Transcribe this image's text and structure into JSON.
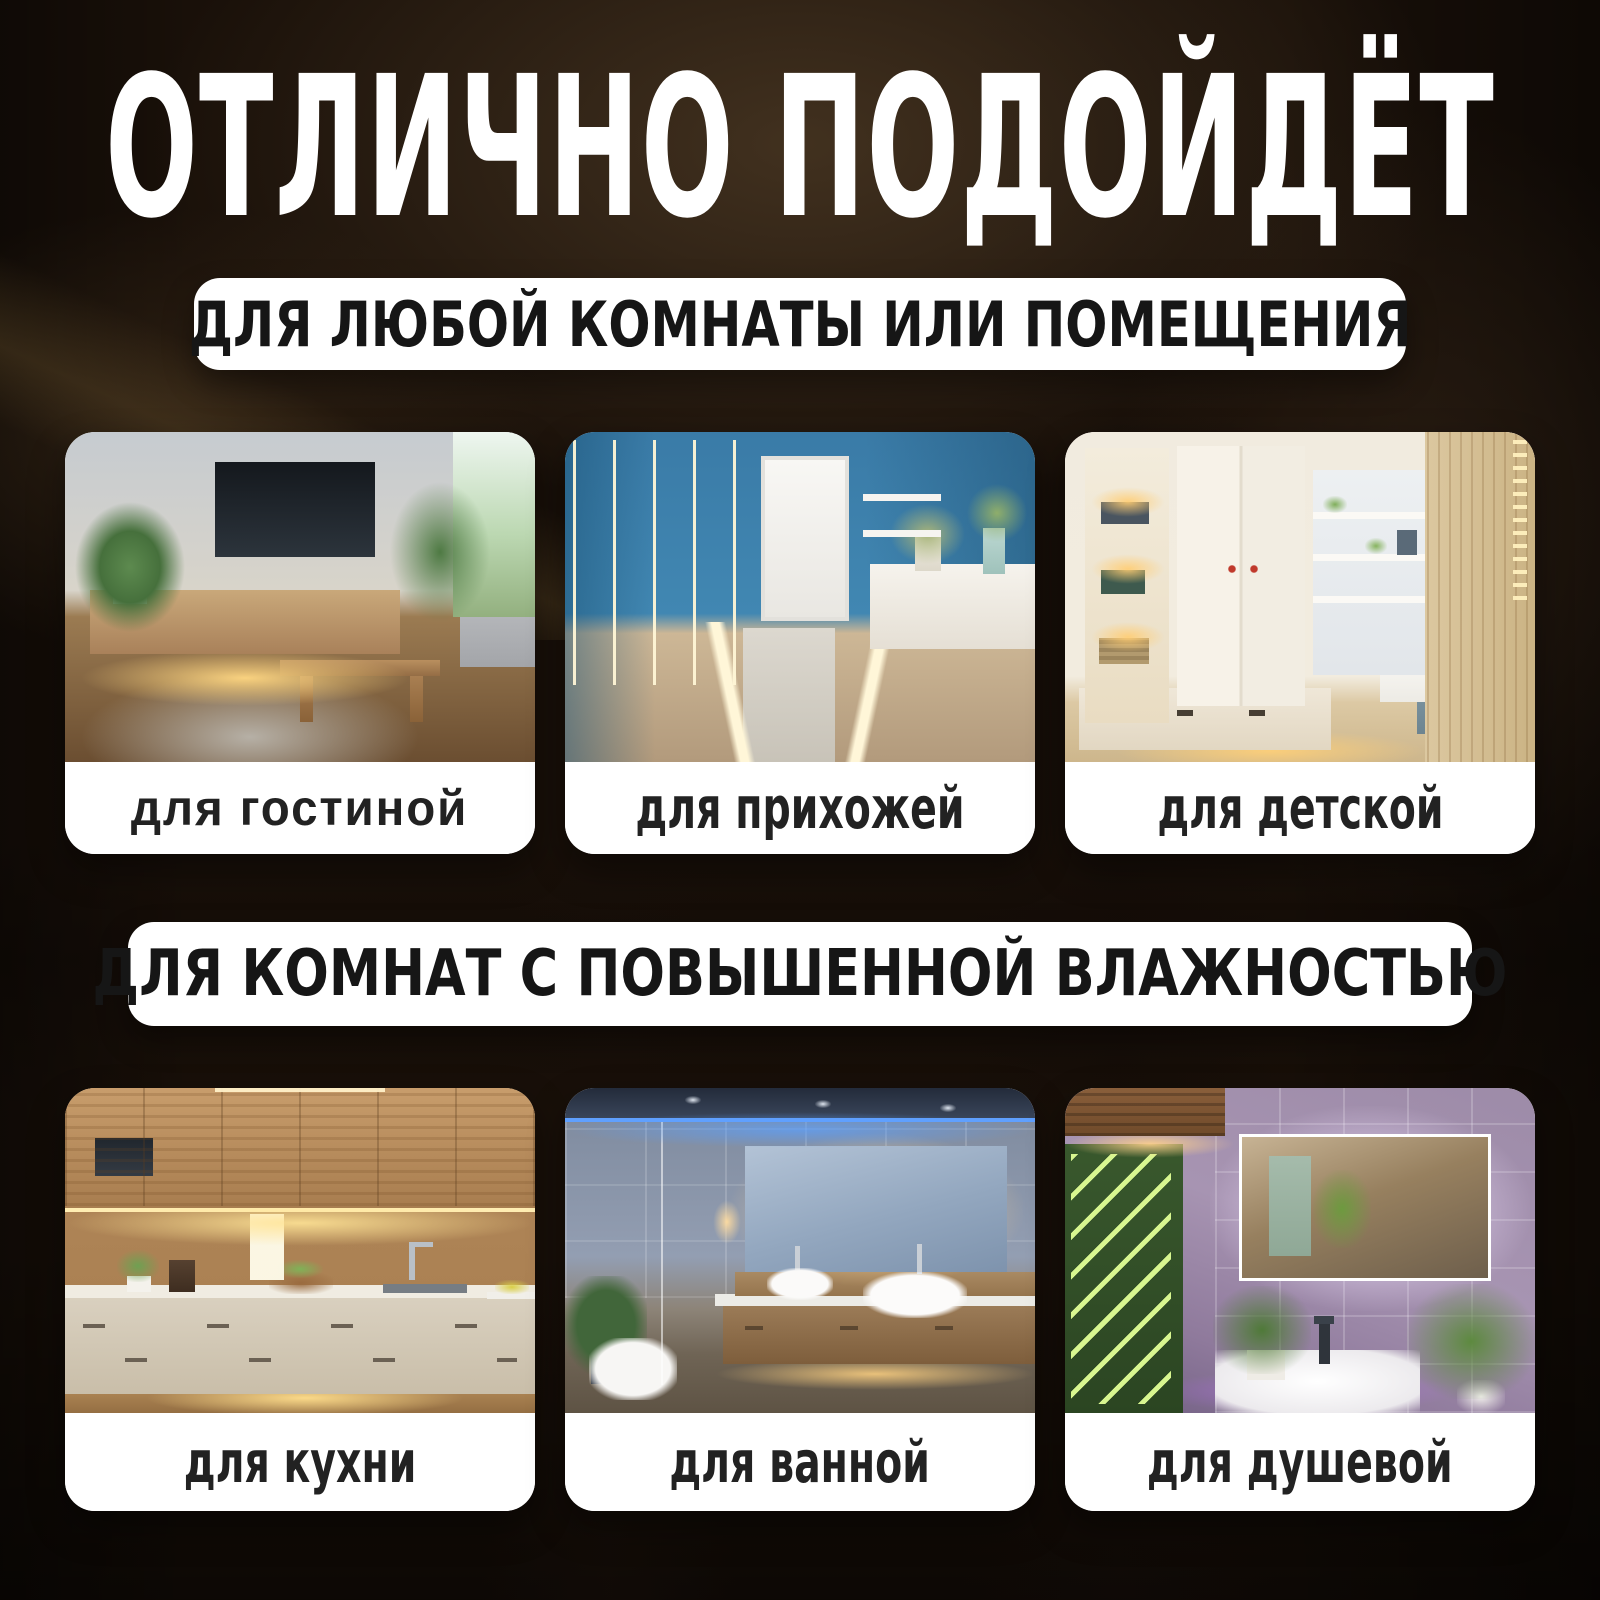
{
  "poster": {
    "title": "ОТЛИЧНО ПОДОЙДЁТ"
  },
  "sections": [
    {
      "banner": "ДЛЯ ЛЮБОЙ КОМНАТЫ ИЛИ ПОМЕЩЕНИЯ",
      "cards": [
        {
          "label": "для гостиной",
          "photo": "living-room-tv-console-with-warm-led-underglow"
        },
        {
          "label": "для прихожей",
          "photo": "blue-hallway-with-vertical-and-floor-led-strips"
        },
        {
          "label": "для детской",
          "photo": "kids-room-shelving-and-bed-with-warm-led-accents"
        }
      ]
    },
    {
      "banner": "ДЛЯ КОМНАТ С ПОВЫШЕННОЙ ВЛАЖНОСТЬЮ",
      "cards": [
        {
          "label": "для кухни",
          "photo": "kitchen-with-under-cabinet-led-lighting"
        },
        {
          "label": "для ванной",
          "photo": "bathroom-with-backlit-mirror-and-blue-ceiling-led"
        },
        {
          "label": "для душевой",
          "photo": "shower-room-with-purple-led-backlit-mirror-and-plants"
        }
      ]
    }
  ],
  "colors": {
    "background": "#191009",
    "banner_bg": "#ffffff",
    "card_bg": "#ffffff",
    "title_color": "#ffffff",
    "text_color": "#1c1c1c"
  }
}
